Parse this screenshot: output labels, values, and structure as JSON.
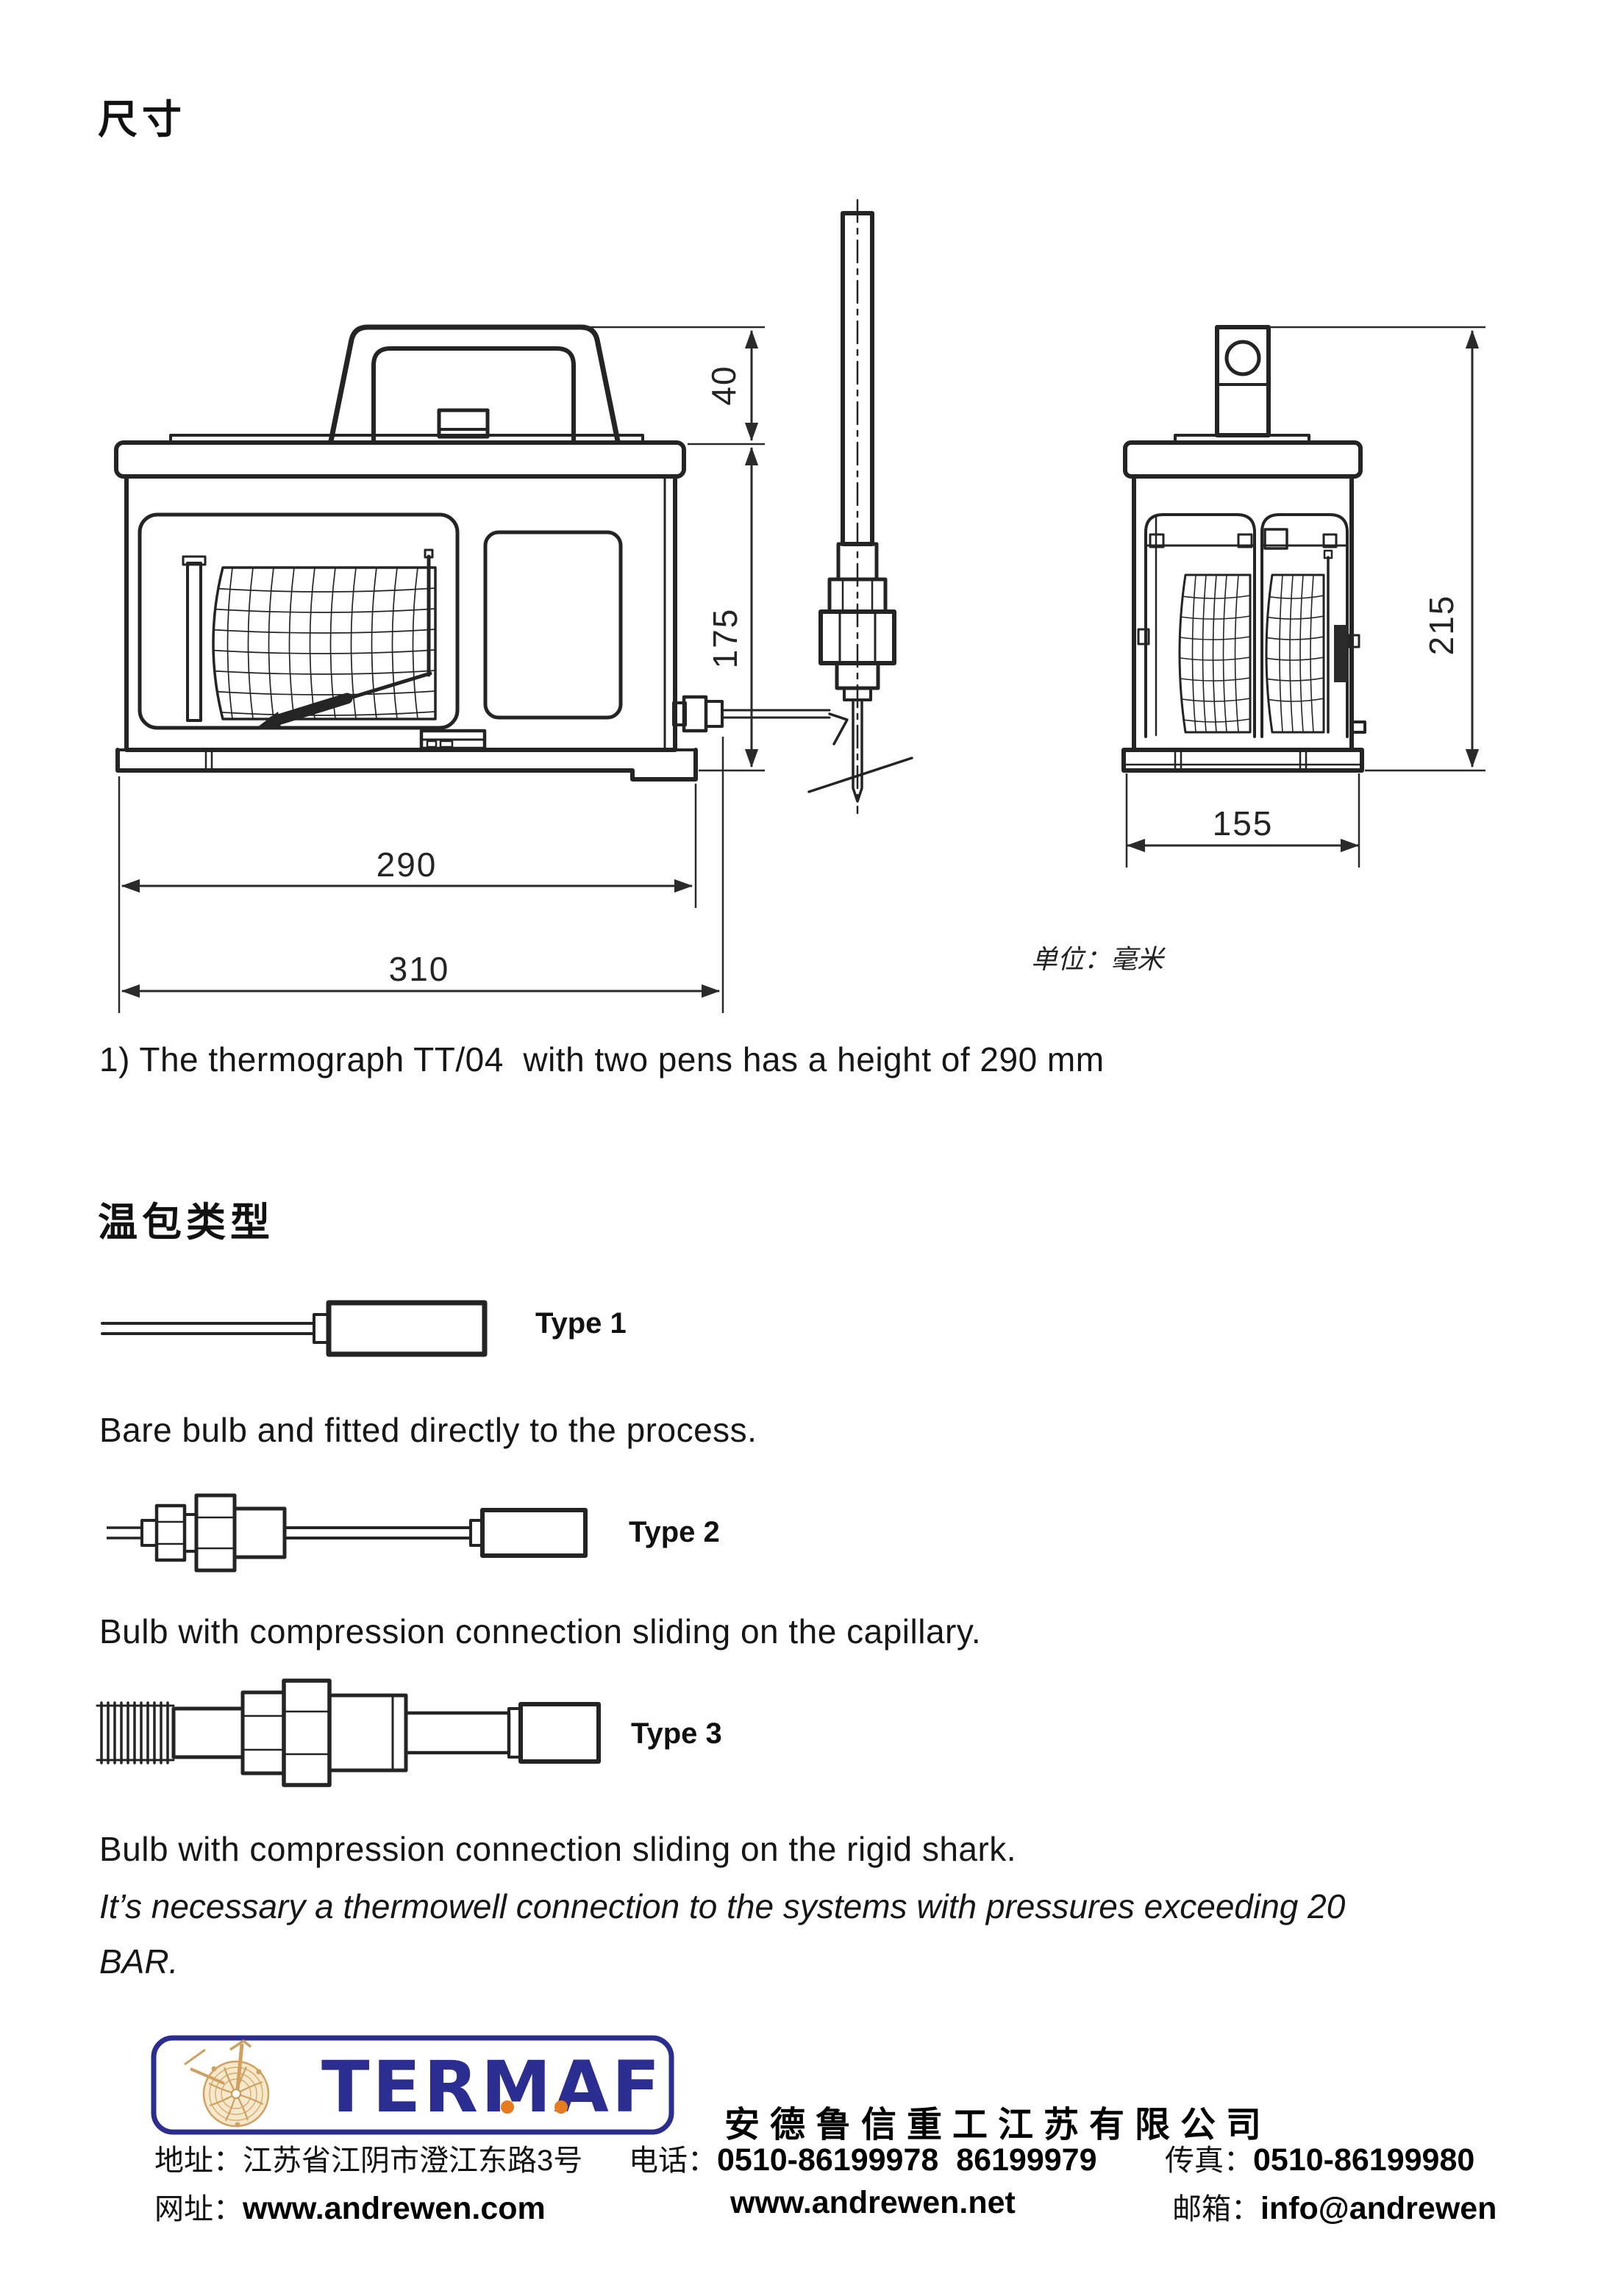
{
  "page": {
    "title_dimensions": "尺寸",
    "title_bulb_types": "温包类型",
    "units_note": "单位：毫米",
    "note1": "1) The thermograph TT/04  with two pens has a height of 290 mm",
    "pressure_note": "It’s necessary a thermowell connection to the systems with pressures exceeding 20 BAR."
  },
  "drawing": {
    "front_view": {
      "handle_height": "40",
      "body_height": "175",
      "width_inner": "290",
      "width_overall": "310"
    },
    "side_view": {
      "height": "215",
      "width": "155"
    }
  },
  "bulb_types": [
    {
      "label": "Type 1",
      "description": "Bare bulb and fitted directly to the process."
    },
    {
      "label": "Type 2",
      "description": "Bulb with compression connection sliding on the capillary."
    },
    {
      "label": "Type 3",
      "description": "Bulb with compression connection sliding on the rigid shark."
    }
  ],
  "footer": {
    "logo_text": "TERMAF",
    "company_name": "安德鲁信重工江苏有限公司",
    "address_label": "地址：",
    "address": "江苏省江阴市澄江东路3号",
    "phone_label": "电话：",
    "phone": "0510-86199978  86199979",
    "fax_label": "传真：",
    "fax": "0510-86199980",
    "web_label": "网址：",
    "web1": "www.andrewen.com",
    "web2": "www.andrewen.net",
    "email_label": "邮箱：",
    "email": "info@andrewen",
    "colors": {
      "blue": "#2b2d90",
      "orange": "#e87b1e",
      "tan": "#cfa05f"
    }
  }
}
